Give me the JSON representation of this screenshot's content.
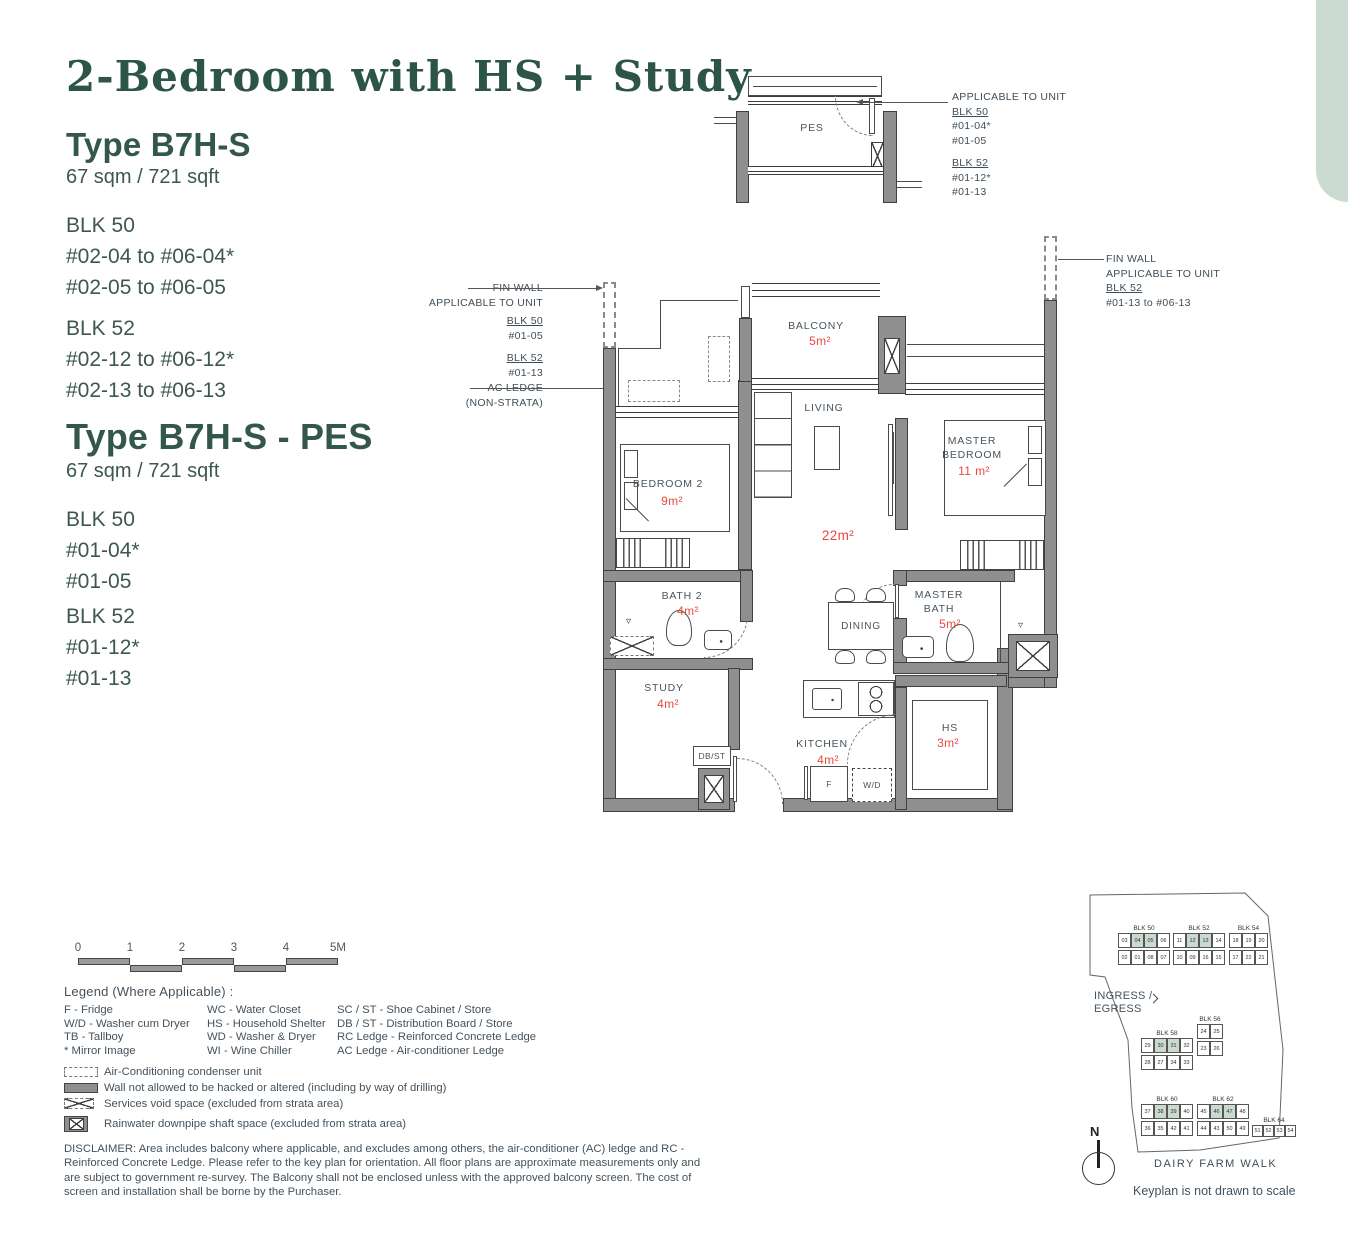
{
  "meta": {
    "heading_color": "#2d5546",
    "body_color": "#3d584c",
    "plan_text_color": "#47545e",
    "area_color": "#e8493f",
    "wall_color": "#8f8f8f",
    "highlight_sage": "#c9dad0",
    "accent_sage": "#ccdbd2"
  },
  "header": {
    "title": "2-Bedroom with HS + Study"
  },
  "types": [
    {
      "name": "Type B7H-S",
      "area": "67 sqm / 721 sqft",
      "blocks": [
        {
          "name": "BLK 50",
          "units": [
            "#02-04 to #06-04*",
            "#02-05 to #06-05"
          ]
        },
        {
          "name": "BLK 52",
          "units": [
            "#02-12 to #06-12*",
            "#02-13 to #06-13"
          ]
        }
      ]
    },
    {
      "name": "Type B7H-S - PES",
      "area": "67 sqm / 721 sqft",
      "blocks": [
        {
          "name": "BLK 50",
          "units": [
            "#01-04*",
            "#01-05"
          ]
        },
        {
          "name": "BLK 52",
          "units": [
            "#01-12*",
            "#01-13"
          ]
        }
      ]
    }
  ],
  "pes_callout": {
    "t": "APPLICABLE TO UNIT",
    "b1": "BLK 50",
    "b1u": [
      "#01-04*",
      "#01-05"
    ],
    "b2": "BLK 52",
    "b2u": [
      "#01-12*",
      "#01-13"
    ]
  },
  "fin_wall_left": {
    "l1": "FIN WALL",
    "l2": "APPLICABLE TO UNIT",
    "b1": "BLK 50",
    "u1": "#01-05",
    "b2": "BLK 52",
    "u2": "#01-13"
  },
  "ac_ledge": {
    "l1": "AC LEDGE",
    "l2": "(NON-STRATA)"
  },
  "fin_wall_right": {
    "l1": "FIN WALL",
    "l2": "APPLICABLE TO UNIT",
    "b1": "BLK 52",
    "u1": "#01-13 to #06-13"
  },
  "rooms": {
    "pes": {
      "label": "PES"
    },
    "balcony": {
      "label": "BALCONY",
      "area": "5m²"
    },
    "living": {
      "label": "LIVING",
      "area": "22m²"
    },
    "master_bedroom": {
      "label": "MASTER BEDROOM",
      "area": "11 m²"
    },
    "bedroom2": {
      "label": "BEDROOM 2",
      "area": "9m²"
    },
    "bath2": {
      "label": "BATH 2",
      "area": "4m²"
    },
    "dining": {
      "label": "DINING"
    },
    "master_bath": {
      "label": "MASTER BATH",
      "area": "5m²"
    },
    "study": {
      "label": "STUDY",
      "area": "4m²"
    },
    "kitchen": {
      "label": "KITCHEN",
      "area": "4m²"
    },
    "hs": {
      "label": "HS",
      "area": "3m²"
    },
    "dbst": {
      "label": "DB/ST"
    },
    "fridge": {
      "label": "F"
    },
    "washer": {
      "label": "W/D"
    }
  },
  "icons": {
    "shower": "▿"
  },
  "scalebar": {
    "ticks": [
      "0",
      "1",
      "2",
      "3",
      "4",
      "5M"
    ]
  },
  "legend": {
    "title": "Legend (Where Applicable) :",
    "columns": [
      [
        "F - Fridge",
        "W/D - Washer cum Dryer",
        "TB - Tallboy",
        "* Mirror Image"
      ],
      [
        "WC - Water Closet",
        "HS - Household Shelter",
        "WD - Washer & Dryer",
        "WI - Wine Chiller"
      ],
      [
        "SC / ST - Shoe Cabinet / Store",
        "DB / ST - Distribution Board / Store",
        "RC Ledge - Reinforced Concrete Ledge",
        "AC Ledge - Air-conditioner Ledge"
      ]
    ],
    "symbols": [
      {
        "type": "ac",
        "label": "Air-Conditioning condenser unit"
      },
      {
        "type": "wall",
        "label": "Wall not allowed to be hacked or altered (including by way of drilling)"
      },
      {
        "type": "void",
        "label": "Services void space (excluded from strata area)"
      },
      {
        "type": "rain",
        "label": "Rainwater downpipe shaft space (excluded from strata area)"
      }
    ]
  },
  "disclaimer": "DISCLAIMER: Area includes balcony where applicable, and excludes among others, the air-conditioner (AC) ledge and RC - Reinforced Concrete Ledge. Please refer to the key plan for orientation. All floor plans are approximate measurements only and are subject to government re-survey. The Balcony shall not be enclosed unless with the approved balcony screen. The cost of screen and installation shall be borne by the Purchaser.",
  "keyplan": {
    "ingress_l1": "INGRESS /",
    "ingress_l2": "EGRESS",
    "road": "DAIRY FARM WALK",
    "note": "Keyplan is not drawn to scale",
    "north": "N",
    "blocks": [
      {
        "name": "BLK 50",
        "top": [
          "03",
          "04",
          "05",
          "06"
        ],
        "bottom": [
          "02",
          "01",
          "08",
          "07"
        ],
        "highlight": [
          "04",
          "05"
        ]
      },
      {
        "name": "BLK 52",
        "top": [
          "11",
          "12",
          "13",
          "14"
        ],
        "bottom": [
          "10",
          "09",
          "16",
          "15"
        ],
        "highlight": [
          "12",
          "13"
        ]
      },
      {
        "name": "BLK 54",
        "top": [
          "18",
          "19",
          "20"
        ],
        "bottom": [
          "17",
          "22",
          "21"
        ],
        "highlight": []
      },
      {
        "name": "BLK 58",
        "top": [
          "29",
          "30",
          "31",
          "32"
        ],
        "bottom": [
          "28",
          "27",
          "34",
          "33"
        ],
        "highlight": [
          "30",
          "31"
        ]
      },
      {
        "name": "BLK 56",
        "top": [
          "24",
          "25"
        ],
        "bottom": [
          "23",
          "26"
        ],
        "highlight": []
      },
      {
        "name": "BLK 60",
        "top": [
          "37",
          "38",
          "39",
          "40"
        ],
        "bottom": [
          "36",
          "35",
          "42",
          "41"
        ],
        "highlight": [
          "38",
          "39"
        ]
      },
      {
        "name": "BLK 62",
        "top": [
          "45",
          "46",
          "47",
          "48"
        ],
        "bottom": [
          "44",
          "43",
          "50",
          "49"
        ],
        "highlight": [
          "46",
          "47"
        ]
      },
      {
        "name": "BLK 64",
        "top": [
          "51",
          "52",
          "53",
          "54"
        ],
        "bottom": [],
        "highlight": []
      }
    ]
  }
}
